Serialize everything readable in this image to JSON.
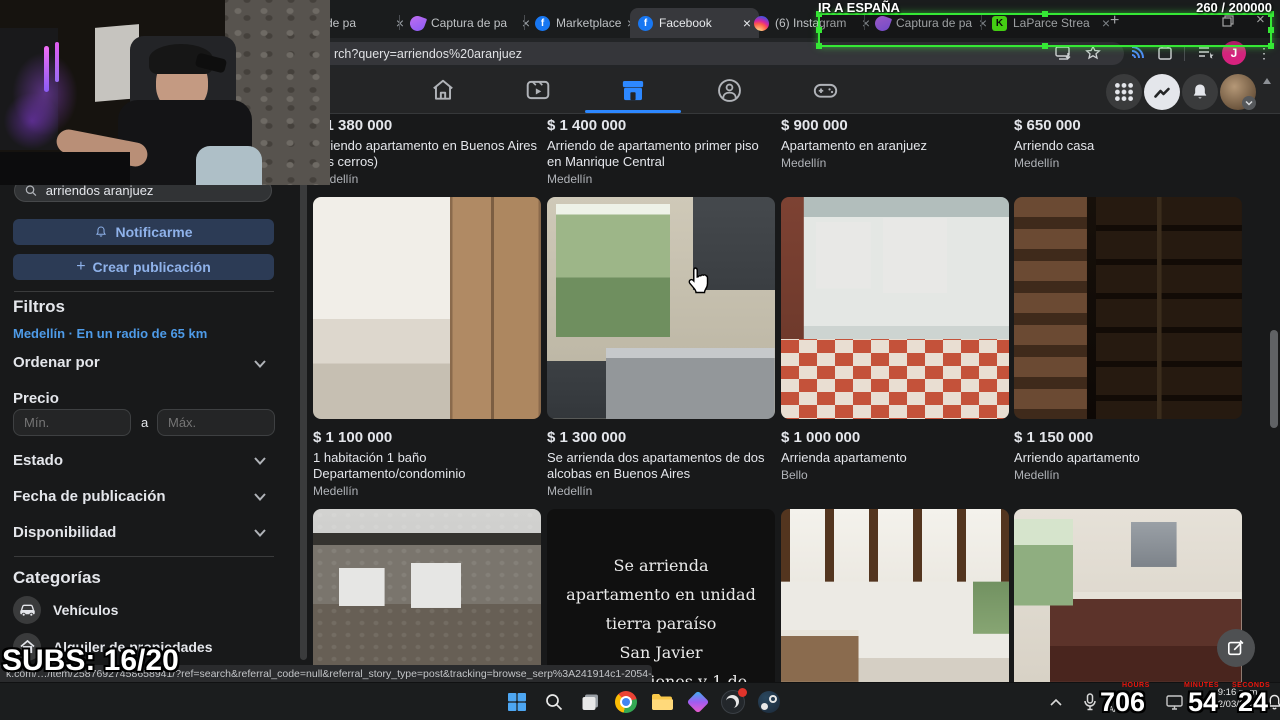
{
  "stream_overlay": {
    "goal": "IR A ESPAÑA",
    "goal_counter": "260  / 200000",
    "subs_counter": "SUBS: 16/20",
    "timer": {
      "labels": [
        "HOURS",
        "MINUTES",
        "SECONDS"
      ],
      "hours": "706",
      "minutes": "54",
      "seconds": "24"
    },
    "accent_green": "#35e835"
  },
  "icons": {
    "close": "×",
    "plus": "+",
    "kebab": "⋮",
    "kick": "K",
    "fb": "f"
  },
  "browser": {
    "tabs": [
      {
        "label": "de pa"
      },
      {
        "label": "Captura de pa"
      },
      {
        "label": "Marketplace: 1"
      },
      {
        "label": "Facebook"
      },
      {
        "label": "(6) Instagram"
      },
      {
        "label": "Captura de pa"
      },
      {
        "label": "LaParce Strea"
      }
    ],
    "url_text": "rch?query=arriendos%20aranjuez",
    "profile_initial": "J"
  },
  "sidebar": {
    "search_value": "arriendos aranjuez",
    "notify_label": "Notificarme",
    "create_label": "Crear publicación",
    "filters_title": "Filtros",
    "location_link": "Medellín · En un radio de 65 km",
    "sort_label": "Ordenar por",
    "price_label": "Precio",
    "price_min_placeholder": "Mín.",
    "price_to": "a",
    "price_max_placeholder": "Máx.",
    "estado_label": "Estado",
    "fecha_label": "Fecha de publicación",
    "disponibilidad_label": "Disponibilidad",
    "categories_title": "Categorías",
    "category_vehicles": "Vehículos",
    "category_rentals": "Alquiler de propiedades"
  },
  "listings": {
    "row1": [
      {
        "price": "$ 1 380 000",
        "title": "Arriendo apartamento en Buenos Aires (los cerros)",
        "location": "Medellín"
      },
      {
        "price": "$ 1 400 000",
        "title": "Arriendo de apartamento primer piso en Manrique Central",
        "location": "Medellín"
      },
      {
        "price": "$ 900 000",
        "title": "Apartamento en aranjuez",
        "location": "Medellín"
      },
      {
        "price": "$ 650 000",
        "title": "Arriendo casa",
        "location": "Medellín"
      }
    ],
    "row2": [
      {
        "price": "$ 1 100 000",
        "title": "1 habitación 1 baño Departamento/condominio",
        "location": "Medellín"
      },
      {
        "price": "$ 1 300 000",
        "title": "Se arrienda dos apartamentos de dos alcobas en Buenos Aires",
        "location": "Medellín"
      },
      {
        "price": "$ 1 000 000",
        "title": "Arrienda apartamento",
        "location": "Bello"
      },
      {
        "price": "$ 1 150 000",
        "title": "Arriendo apartamento",
        "location": "Medellín"
      }
    ],
    "row3_text_card_lines": [
      "Se arrienda",
      "apartamento en unidad",
      "tierra paraíso",
      "San Javier",
      "3 habitaciones y 1 de"
    ]
  },
  "statusbar": {
    "link_preview": "k.com/…/item/25876927458658941/?ref=search&referral_code=null&referral_story_type=post&tracking=browse_serp%3A241914c1-2054-4922-9c7d-15f70fb29908&__tn__=!%3AD"
  },
  "taskbar": {
    "time": "9:16 p. m.",
    "date": "12/03/2025",
    "lang": "LAA"
  }
}
